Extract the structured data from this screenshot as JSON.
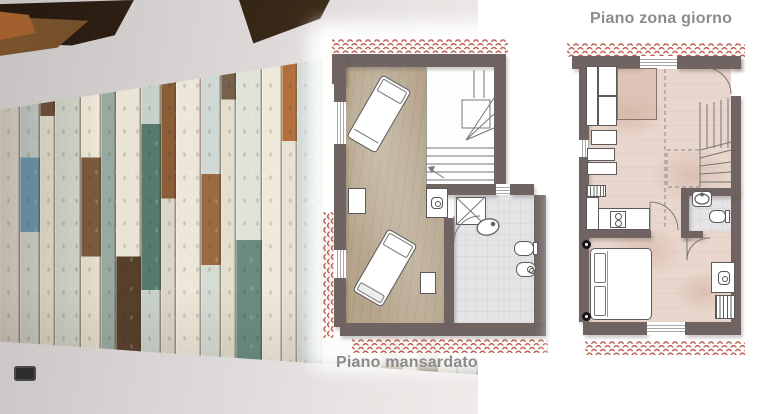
{
  "labels": {
    "plan_left": "Piano mansardato",
    "plan_right": "Piano zona giorno"
  },
  "colors": {
    "wall": "#6f6462",
    "wood": "#b5a48b",
    "pink": "#e9d6cc",
    "bath": "#e4e4e6",
    "tile_red": "#b3493c",
    "tile_fill": "#f6e9e4",
    "label": "#8b8b8b",
    "stroke": "#5a5a5a"
  },
  "photo": {
    "planks": [
      {
        "w": 4,
        "segs": [
          [
            "#e3ded1",
            100
          ]
        ]
      },
      {
        "w": 4,
        "segs": [
          [
            "#c9d3cd",
            38
          ],
          [
            "#6f9ab5",
            18
          ],
          [
            "#d6dad1",
            44
          ]
        ]
      },
      {
        "w": 3,
        "segs": [
          [
            "#6f5139",
            28
          ],
          [
            "#e8e3d4",
            72
          ]
        ]
      },
      {
        "w": 5,
        "segs": [
          [
            "#d4d8cd",
            100
          ]
        ]
      },
      {
        "w": 4,
        "segs": [
          [
            "#efe9da",
            38
          ],
          [
            "#7b5b3d",
            24
          ],
          [
            "#e6dfcf",
            38
          ]
        ]
      },
      {
        "w": 3,
        "segs": [
          [
            "#97aaa2",
            100
          ]
        ]
      },
      {
        "w": 5,
        "segs": [
          [
            "#e9e4d6",
            62
          ],
          [
            "#56402c",
            38
          ]
        ]
      },
      {
        "w": 4,
        "segs": [
          [
            "#c7d0c9",
            30
          ],
          [
            "#557a6e",
            40
          ],
          [
            "#c9d2cb",
            30
          ]
        ]
      },
      {
        "w": 3,
        "segs": [
          [
            "#8b5e38",
            48
          ],
          [
            "#dcd6c6",
            52
          ]
        ]
      },
      {
        "w": 5,
        "segs": [
          [
            "#ece7d9",
            100
          ]
        ]
      },
      {
        "w": 4,
        "segs": [
          [
            "#cfd8d2",
            42
          ],
          [
            "#9a6b41",
            22
          ],
          [
            "#d5dcd4",
            36
          ]
        ]
      },
      {
        "w": 3,
        "segs": [
          [
            "#75614c",
            24
          ],
          [
            "#e4decf",
            76
          ]
        ]
      },
      {
        "w": 5,
        "segs": [
          [
            "#dfe3da",
            58
          ],
          [
            "#6b8d81",
            42
          ]
        ]
      },
      {
        "w": 4,
        "segs": [
          [
            "#efe9dc",
            100
          ]
        ]
      },
      {
        "w": 3,
        "segs": [
          [
            "#b06f3c",
            34
          ],
          [
            "#e8e2d3",
            66
          ]
        ]
      },
      {
        "w": 5,
        "segs": [
          [
            "#ccd5cf",
            100
          ]
        ]
      },
      {
        "w": 4,
        "segs": [
          [
            "#e6e1d2",
            52
          ],
          [
            "#7c5a3a",
            22
          ],
          [
            "#ddd7c8",
            26
          ]
        ]
      },
      {
        "w": 3,
        "segs": [
          [
            "#5d4a35",
            40
          ],
          [
            "#cfd7d0",
            60
          ]
        ]
      },
      {
        "w": 5,
        "segs": [
          [
            "#e9e4d5",
            100
          ]
        ]
      },
      {
        "w": 4,
        "segs": [
          [
            "#c2cdc7",
            50
          ],
          [
            "#8d6a45",
            50
          ]
        ]
      },
      {
        "w": 3,
        "segs": [
          [
            "#e4dfd0",
            100
          ]
        ]
      },
      {
        "w": 4,
        "segs": [
          [
            "#d7dcd2",
            66
          ],
          [
            "#66503a",
            34
          ]
        ]
      },
      {
        "w": 4,
        "segs": [
          [
            "#e9e5d8",
            30
          ],
          [
            "#a97b4a",
            20
          ],
          [
            "#dcd8ca",
            50
          ]
        ]
      },
      {
        "w": 4,
        "segs": [
          [
            "#cdd6d0",
            100
          ]
        ]
      }
    ]
  }
}
